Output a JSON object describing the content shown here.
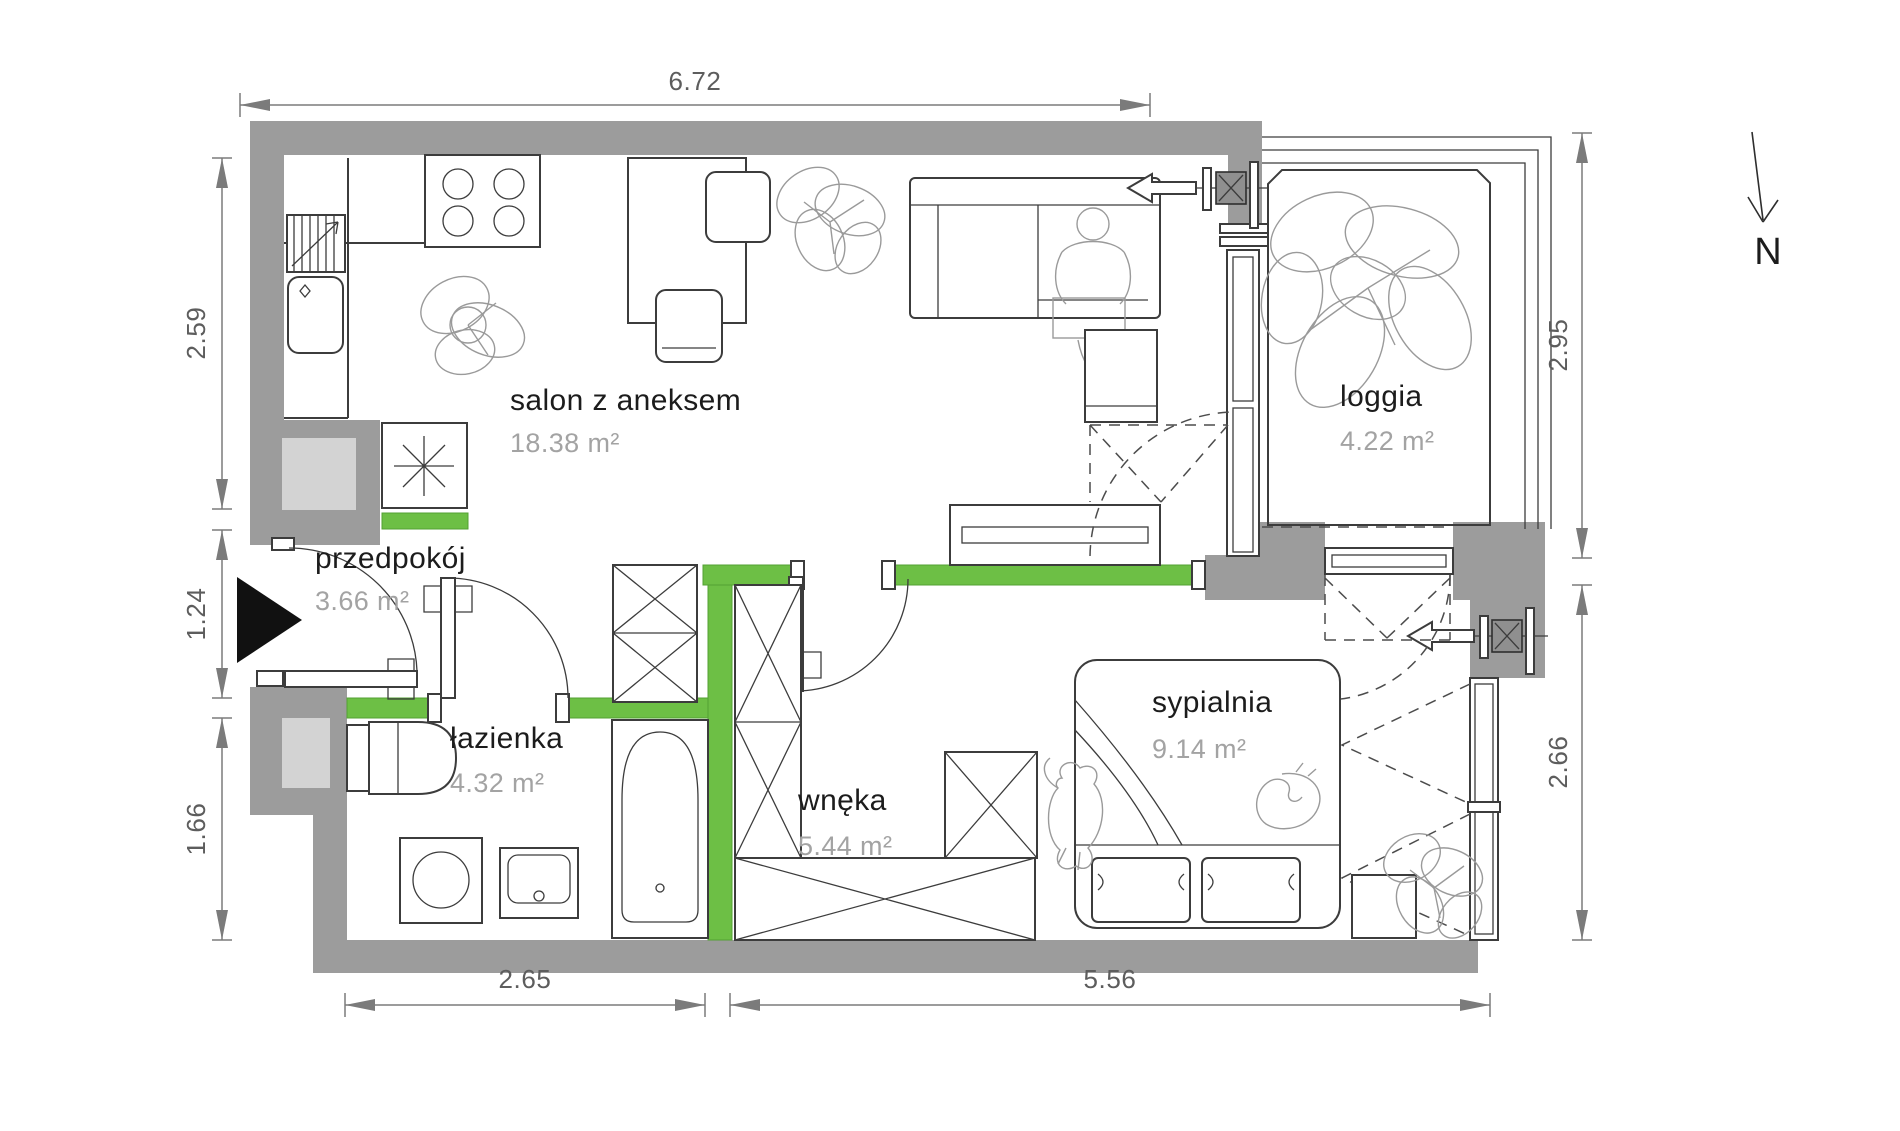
{
  "plan": {
    "type": "apartment-floor-plan",
    "rooms": [
      {
        "id": "salon",
        "name": "salon z aneksem",
        "area": "18.38 m²"
      },
      {
        "id": "loggia",
        "name": "loggia",
        "area": "4.22 m²"
      },
      {
        "id": "przedpokoj",
        "name": "przedpokój",
        "area": "3.66 m²"
      },
      {
        "id": "lazienka",
        "name": "łazienka",
        "area": "4.32 m²"
      },
      {
        "id": "wneka",
        "name": "wnęka",
        "area": "5.44 m²"
      },
      {
        "id": "sypialnia",
        "name": "sypialnia",
        "area": "9.14 m²"
      }
    ],
    "dimensions": {
      "top": "6.72",
      "left_upper": "2.59",
      "left_middle": "1.24",
      "left_lower": "1.66",
      "right_upper": "2.95",
      "right_lower": "2.66",
      "bottom_left": "2.65",
      "bottom_right": "5.56"
    },
    "compass": {
      "label": "N"
    },
    "colors": {
      "wall": "#9c9c9c",
      "wall_shaft": "#d3d3d3",
      "partition_green": "#6dbf45",
      "furniture_line": "#3c3c3c",
      "sketch_line": "#9a9a9a",
      "dimension": "#5d5d5d",
      "room_name": "#1c1c1c",
      "room_area": "#a3a3a3"
    }
  }
}
